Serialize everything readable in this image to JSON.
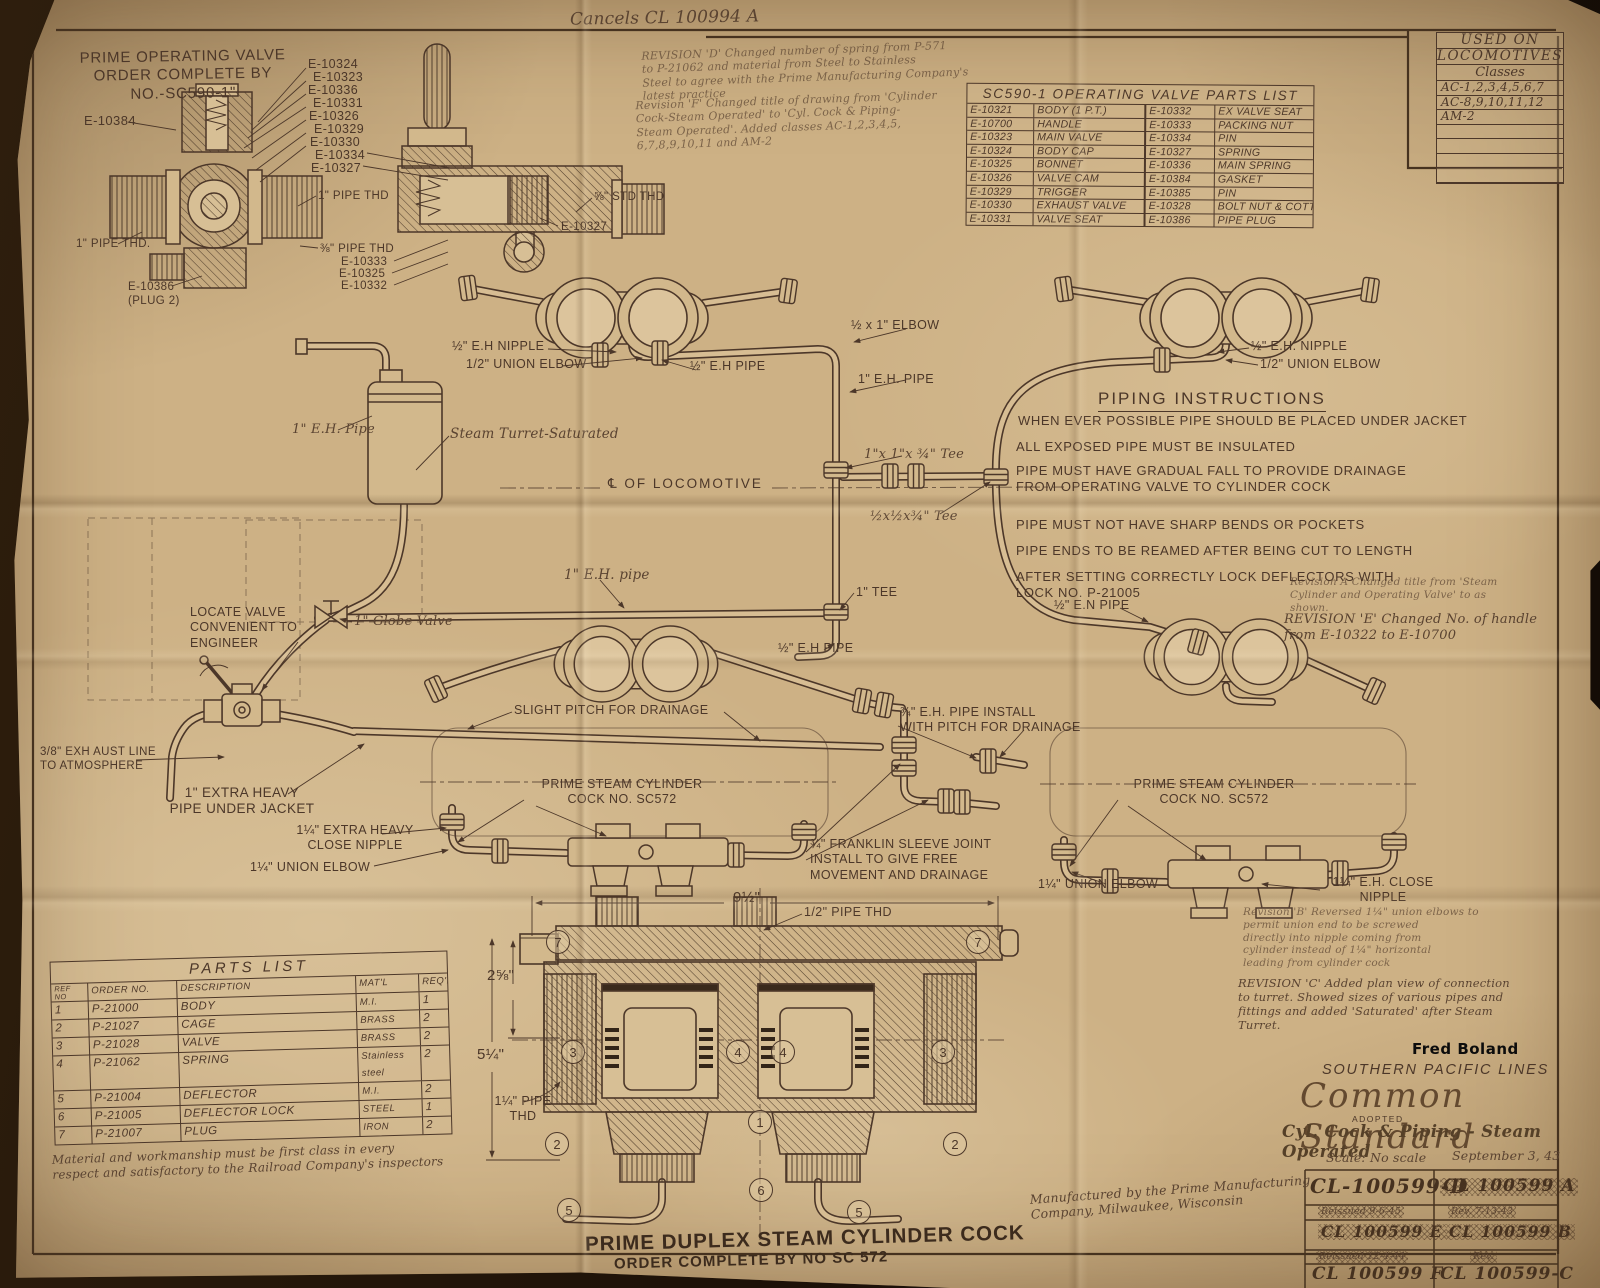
{
  "colors": {
    "paper": "#cdb185",
    "ink": "#4c3729"
  },
  "labels": [
    {
      "t": "Cancels CL 100994 A",
      "x": 570,
      "y": 8,
      "fs": 17,
      "cls": "hw",
      "rot": -1
    },
    {
      "t": "PRIME OPERATING VALVE\nORDER COMPLETE BY\nNO.-SC590-1\"",
      "x": 76,
      "y": 48,
      "fs": 15,
      "ta": "center",
      "w": 214,
      "cls": "ttl",
      "rot": -1
    },
    {
      "t": "REVISION 'D' Changed number of spring from P-571\nto P-21062 and material from Steel to Stainless\nSteel to agree with the Prime Manufacturing Company's\nlatest practice",
      "x": 642,
      "y": 44,
      "fs": 11,
      "cls": "hw faint",
      "rot": -2
    },
    {
      "t": "Revision 'F' Changed title of drawing from 'Cylinder\nCock-Steam Operated' to 'Cyl. Cock & Piping-\nSteam Operated'. Added classes AC-1,2,3,4,5,\n6,7,8,9,10,11 and AM-2",
      "x": 636,
      "y": 94,
      "fs": 11,
      "cls": "hw faint",
      "rot": -2
    },
    {
      "t": "E-10384",
      "x": 84,
      "y": 113,
      "fs": 13
    },
    {
      "t": "E-10324",
      "x": 308,
      "y": 57
    },
    {
      "t": "E-10323",
      "x": 313,
      "y": 70
    },
    {
      "t": "E-10336",
      "x": 308,
      "y": 83
    },
    {
      "t": "E-10331",
      "x": 313,
      "y": 96
    },
    {
      "t": "E-10326",
      "x": 309,
      "y": 109
    },
    {
      "t": "E-10329",
      "x": 314,
      "y": 122
    },
    {
      "t": "E-10330",
      "x": 310,
      "y": 135
    },
    {
      "t": "E-10334",
      "x": 315,
      "y": 148
    },
    {
      "t": "E-10327",
      "x": 311,
      "y": 161
    },
    {
      "t": "1\" PIPE THD",
      "x": 318,
      "y": 189,
      "fs": 11.5
    },
    {
      "t": "⅜\" PIPE THD",
      "x": 320,
      "y": 242,
      "fs": 11.5
    },
    {
      "t": "E-10333",
      "x": 341,
      "y": 255,
      "fs": 11.5
    },
    {
      "t": "E-10325",
      "x": 339,
      "y": 267,
      "fs": 11.5
    },
    {
      "t": "E-10332",
      "x": 341,
      "y": 279,
      "fs": 11.5
    },
    {
      "t": "⅝\" STD THD",
      "x": 594,
      "y": 190,
      "fs": 11.5
    },
    {
      "t": "E-10327",
      "x": 561,
      "y": 220,
      "fs": 11.5
    },
    {
      "t": "1\" PIPE THD.",
      "x": 76,
      "y": 237,
      "fs": 11.5
    },
    {
      "t": "E-10386\n(PLUG 2)",
      "x": 128,
      "y": 280,
      "fs": 11.5
    },
    {
      "t": "½\" E.H NIPPLE",
      "x": 452,
      "y": 339
    },
    {
      "t": "1/2\" UNION ELBOW",
      "x": 466,
      "y": 357
    },
    {
      "t": "½\" E.H PIPE",
      "x": 690,
      "y": 359
    },
    {
      "t": "½ x 1\" ELBOW",
      "x": 851,
      "y": 318
    },
    {
      "t": "1\" E.H. PIPE",
      "x": 858,
      "y": 372
    },
    {
      "t": "½\" E.H. NIPPLE",
      "x": 1251,
      "y": 339
    },
    {
      "t": "1/2\" UNION ELBOW",
      "x": 1260,
      "y": 357
    },
    {
      "t": "1\" E.H. Pipe",
      "x": 292,
      "y": 422,
      "cls": "hw",
      "fs": 13
    },
    {
      "t": "Steam Turret-Saturated",
      "x": 450,
      "y": 426,
      "cls": "hw",
      "fs": 13.5
    },
    {
      "t": "1\"x 1\"x ¾\" Tee",
      "x": 864,
      "y": 447,
      "cls": "hw",
      "fs": 13
    },
    {
      "t": "℄ OF LOCOMOTIVE",
      "x": 608,
      "y": 476,
      "fs": 13.5,
      "ls": 2
    },
    {
      "t": "½x½x¾\" Tee",
      "x": 870,
      "y": 509,
      "cls": "hw",
      "fs": 13
    },
    {
      "t": "1\" E.H. pipe",
      "x": 564,
      "y": 567,
      "cls": "hw",
      "fs": 13.5
    },
    {
      "t": "1\" TEE",
      "x": 856,
      "y": 585
    },
    {
      "t": "Revision A  Changed title from 'Steam\nCylinder and Operating Valve' to as\nshown.",
      "x": 1290,
      "y": 576,
      "fs": 10.5,
      "cls": "hw faint"
    },
    {
      "t": "REVISION 'E' Changed No. of handle\nfrom E-10322 to E-10700",
      "x": 1284,
      "y": 612,
      "fs": 13,
      "cls": "hw"
    },
    {
      "t": "LOCATE VALVE\nCONVENIENT TO\nENGINEER",
      "x": 190,
      "y": 605
    },
    {
      "t": "1\" Globe Valve",
      "x": 354,
      "y": 614,
      "cls": "hw",
      "fs": 13
    },
    {
      "t": "½\" E.N PIPE",
      "x": 1054,
      "y": 598
    },
    {
      "t": "½\" E.H PIPE",
      "x": 778,
      "y": 641
    },
    {
      "t": "SLIGHT PITCH FOR DRAINAGE",
      "x": 514,
      "y": 703
    },
    {
      "t": "¾\" E.H. PIPE INSTALL\nWITH PITCH FOR DRAINAGE",
      "x": 900,
      "y": 705
    },
    {
      "t": "3/8\" EXH AUST LINE\nTO ATMOSPHERE",
      "x": 40,
      "y": 745,
      "fs": 11.5
    },
    {
      "t": "1\" EXTRA HEAVY\nPIPE UNDER JACKET",
      "x": 166,
      "y": 785,
      "fs": 13.5,
      "ta": "center",
      "w": 152
    },
    {
      "t": "PRIME STEAM CYLINDER\nCOCK NO. SC572",
      "x": 528,
      "y": 777,
      "ta": "center",
      "w": 188
    },
    {
      "t": "PRIME STEAM CYLINDER\nCOCK NO. SC572",
      "x": 1120,
      "y": 777,
      "ta": "center",
      "w": 188
    },
    {
      "t": "1¼\" EXTRA HEAVY\nCLOSE NIPPLE",
      "x": 284,
      "y": 823,
      "ta": "center",
      "w": 142
    },
    {
      "t": "1¼\" UNION ELBOW",
      "x": 250,
      "y": 860
    },
    {
      "t": "¾\" FRANKLIN SLEEVE JOINT\nINSTALL TO GIVE FREE\nMOVEMENT AND DRAINAGE",
      "x": 810,
      "y": 837
    },
    {
      "t": "1¼\" UNION ELBOW",
      "x": 1038,
      "y": 877
    },
    {
      "t": "1¼\" E.H. CLOSE\nNIPPLE",
      "x": 1322,
      "y": 875,
      "ta": "center",
      "w": 122
    },
    {
      "t": "9½\"",
      "x": 733,
      "y": 889,
      "fs": 15
    },
    {
      "t": "1/2\" PIPE THD",
      "x": 804,
      "y": 905
    },
    {
      "t": "2⅝\"",
      "x": 487,
      "y": 967,
      "fs": 15
    },
    {
      "t": "5¼\"",
      "x": 477,
      "y": 1046,
      "fs": 15
    },
    {
      "t": "1¼\" PIPE\nTHD",
      "x": 492,
      "y": 1094,
      "ta": "center",
      "w": 62
    },
    {
      "t": "Revision 'B' Reversed 1¼\" union elbows to\npermit union end to be screwed\ndirectly into nipple coming from\ncylinder instead of 1¼\" horizontal\nleading from cylinder cock",
      "x": 1243,
      "y": 906,
      "fs": 10.5,
      "cls": "hw faint"
    },
    {
      "t": "REVISION 'C' Added plan view of connection\nto turret. Showed sizes of various pipes and\nfittings and added 'Saturated' after Steam\nTurret.",
      "x": 1238,
      "y": 976,
      "fs": 11.5,
      "cls": "hw"
    },
    {
      "t": "Fred Boland",
      "x": 1412,
      "y": 1040,
      "fs": 15,
      "cls": "wm"
    },
    {
      "t": "SOUTHERN PACIFIC LINES",
      "x": 1322,
      "y": 1062,
      "fs": 14.5,
      "ls": 1.8,
      "cls": "ital"
    },
    {
      "t": "Common Standard",
      "x": 1300,
      "y": 1076,
      "fs": 34,
      "cls": "script"
    },
    {
      "t": "ADOPTED",
      "x": 1352,
      "y": 1114,
      "fs": 8.5,
      "ls": 1.5
    },
    {
      "t": "Cyl. Cock & Piping - Steam Operated",
      "x": 1282,
      "y": 1122,
      "fs": 16.5,
      "cls": "script2"
    },
    {
      "t": "Scale: No scale",
      "x": 1326,
      "y": 1150,
      "fs": 12.5,
      "cls": "hw"
    },
    {
      "t": "September 3, 43",
      "x": 1452,
      "y": 1148,
      "fs": 12.5,
      "cls": "hw"
    },
    {
      "t": "CL-100599-D",
      "x": 1310,
      "y": 1176,
      "fs": 20,
      "cls": "tbm"
    },
    {
      "t": "CL 100599 A",
      "x": 1440,
      "y": 1178,
      "fs": 17,
      "cls": "tbm xout"
    },
    {
      "t": "Reissued 9-6-45",
      "x": 1318,
      "y": 1206,
      "fs": 9.5,
      "cls": "hw xout"
    },
    {
      "t": "Rev. 7-13-43",
      "x": 1448,
      "y": 1206,
      "fs": 9.5,
      "cls": "hw xout"
    },
    {
      "t": "CL 100599 E",
      "x": 1318,
      "y": 1224,
      "fs": 15.5,
      "cls": "tbm xout"
    },
    {
      "t": "CL 100599 B",
      "x": 1446,
      "y": 1224,
      "fs": 15.5,
      "cls": "tbm xout"
    },
    {
      "t": "Reissued 12-4-44",
      "x": 1316,
      "y": 1251,
      "fs": 9.5,
      "cls": "hw xout"
    },
    {
      "t": "Rev.",
      "x": 1470,
      "y": 1251,
      "fs": 9.5,
      "cls": "hw xout"
    },
    {
      "t": "CL 100599 F",
      "x": 1312,
      "y": 1266,
      "fs": 17,
      "cls": "tbm"
    },
    {
      "t": "CL 100599-C",
      "x": 1440,
      "y": 1266,
      "fs": 17,
      "cls": "tbm"
    },
    {
      "t": "Manufactured by the Prime Manufacturing\nCompany, Milwaukee, Wisconsin",
      "x": 1030,
      "y": 1182,
      "cls": "hw",
      "fs": 12.5,
      "rot": -4
    },
    {
      "t": "PRIME DUPLEX STEAM CYLINDER COCK",
      "x": 585,
      "y": 1226,
      "fs": 20.5,
      "ls": 1,
      "cls": "dark",
      "rot": -1.5
    },
    {
      "t": "ORDER COMPLETE BY NO SC 572",
      "x": 614,
      "y": 1252,
      "fs": 15,
      "ls": 1,
      "cls": "dark",
      "rot": -1.5
    }
  ],
  "instructions": {
    "title": "PIPING INSTRUCTIONS",
    "lines": [
      {
        "t": "WHEN EVER POSSIBLE PIPE SHOULD BE PLACED UNDER JACKET",
        "x": 1018,
        "y": 413
      },
      {
        "t": "ALL EXPOSED PIPE MUST BE INSULATED",
        "x": 1016,
        "y": 439
      },
      {
        "t": "PIPE MUST HAVE GRADUAL FALL TO PROVIDE DRAINAGE\nFROM OPERATING VALVE TO CYLINDER COCK",
        "x": 1016,
        "y": 463
      },
      {
        "t": "PIPE MUST NOT HAVE SHARP BENDS OR POCKETS",
        "x": 1016,
        "y": 517
      },
      {
        "t": "PIPE ENDS TO BE REAMED AFTER BEING CUT TO LENGTH",
        "x": 1016,
        "y": 543
      },
      {
        "t": "AFTER SETTING CORRECTLY LOCK DEFLECTORS WITH\nLOCK NO. P-21005",
        "x": 1016,
        "y": 569
      }
    ]
  },
  "used_on": {
    "title": "USED ON",
    "title2": "LOCOMOTIVES",
    "subtitle": "Classes",
    "rows": [
      "AC-1,2,3,4,5,6,7",
      "AC-8,9,10,11,12",
      "AM-2",
      "",
      "",
      "",
      ""
    ]
  },
  "op_parts": {
    "title": "SC590-1 OPERATING VALVE PARTS LIST",
    "rows": [
      [
        "E-10321",
        "BODY (1 P.T.)",
        "E-10332",
        "EX VALVE SEAT"
      ],
      [
        "E-10700",
        "HANDLE",
        "E-10333",
        "PACKING NUT"
      ],
      [
        "E-10323",
        "MAIN VALVE",
        "E-10334",
        "PIN"
      ],
      [
        "E-10324",
        "BODY CAP",
        "E-10327",
        "SPRING"
      ],
      [
        "E-10325",
        "BONNET",
        "E-10336",
        "MAIN SPRING"
      ],
      [
        "E-10326",
        "VALVE CAM",
        "E-10384",
        "GASKET"
      ],
      [
        "E-10329",
        "TRIGGER",
        "E-10385",
        "PIN"
      ],
      [
        "E-10330",
        "EXHAUST VALVE",
        "E-10328",
        "BOLT NUT & COTTER"
      ],
      [
        "E-10331",
        "VALVE SEAT",
        "E-10386",
        "PIPE PLUG"
      ]
    ]
  },
  "parts_list": {
    "title": "PARTS LIST",
    "headers": [
      "REF\nNO",
      "ORDER NO.",
      "DESCRIPTION",
      "MAT'L",
      "REQ'D"
    ],
    "rows": [
      [
        "1",
        "P-21000",
        "BODY",
        "M.I.",
        "1"
      ],
      [
        "2",
        "P-21027",
        "CAGE",
        "BRASS",
        "2"
      ],
      [
        "3",
        "P-21028",
        "VALVE",
        "BRASS",
        "2"
      ],
      [
        "4",
        "P-21062",
        "SPRING",
        "Stainless steel",
        "2"
      ],
      [
        "5",
        "P-21004",
        "DEFLECTOR",
        "M.I.",
        "2"
      ],
      [
        "6",
        "P-21005",
        "DEFLECTOR LOCK",
        "STEEL",
        "1"
      ],
      [
        "7",
        "P-21007",
        "PLUG",
        "IRON",
        "2"
      ]
    ],
    "note": "Material and workmanship must be first class in every\nrespect and satisfactory to the Railroad Company's inspectors"
  },
  "circles": [
    {
      "n": "7",
      "x": 546,
      "y": 930
    },
    {
      "n": "7",
      "x": 966,
      "y": 930
    },
    {
      "n": "3",
      "x": 561,
      "y": 1040
    },
    {
      "n": "4",
      "x": 726,
      "y": 1040
    },
    {
      "n": "4",
      "x": 771,
      "y": 1040
    },
    {
      "n": "3",
      "x": 931,
      "y": 1040
    },
    {
      "n": "2",
      "x": 545,
      "y": 1132
    },
    {
      "n": "1",
      "x": 748,
      "y": 1110
    },
    {
      "n": "2",
      "x": 943,
      "y": 1132
    },
    {
      "n": "5",
      "x": 557,
      "y": 1198
    },
    {
      "n": "6",
      "x": 749,
      "y": 1178
    },
    {
      "n": "5",
      "x": 847,
      "y": 1200
    }
  ]
}
